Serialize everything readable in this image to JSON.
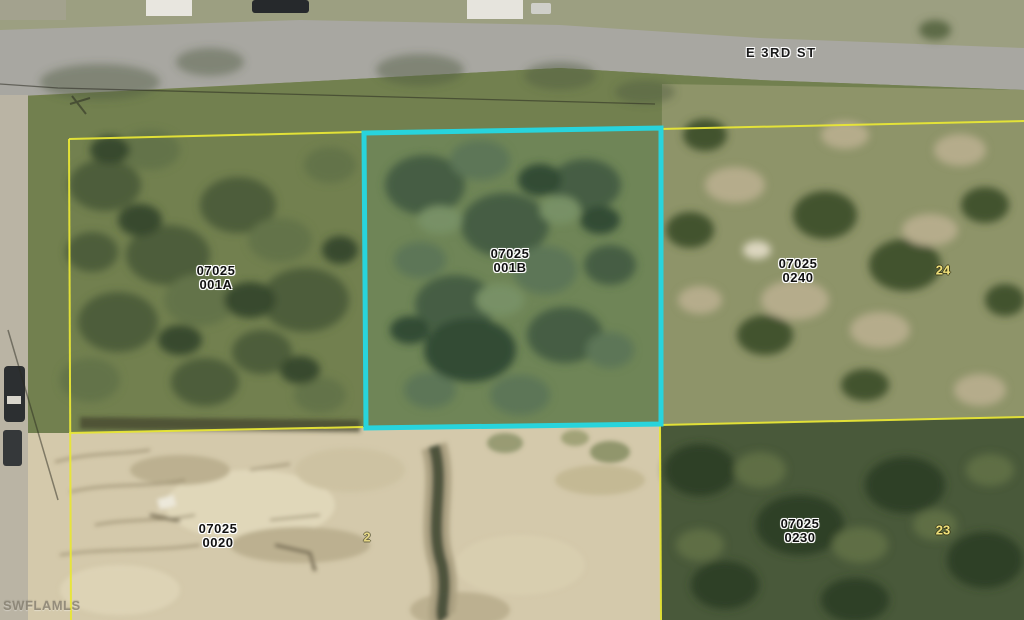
{
  "map": {
    "street_label": "E 3RD ST",
    "watermark": "SWFLAMLS",
    "parcels": [
      {
        "name": "parcel-07025-001A",
        "line1": "07025",
        "line2": "001A",
        "highlighted": false
      },
      {
        "name": "parcel-07025-001B",
        "line1": "07025",
        "line2": "001B",
        "highlighted": true
      },
      {
        "name": "parcel-07025-0240",
        "line1": "07025",
        "line2": "0240",
        "highlighted": false
      },
      {
        "name": "parcel-07025-0020",
        "line1": "07025",
        "line2": "0020",
        "highlighted": false
      },
      {
        "name": "parcel-07025-0230",
        "line1": "07025",
        "line2": "0230",
        "highlighted": false
      }
    ],
    "lot_numbers": [
      {
        "value": "24"
      },
      {
        "value": "2"
      },
      {
        "value": "23"
      }
    ],
    "colors": {
      "highlight_boundary": "#28d4dc",
      "parcel_boundary": "#e8e636",
      "lot_number_text": "#f0e07a",
      "parcel_label_text": "#101010",
      "street_label_text": "#1a1a1a",
      "watermark_text": "#847d6e"
    }
  }
}
